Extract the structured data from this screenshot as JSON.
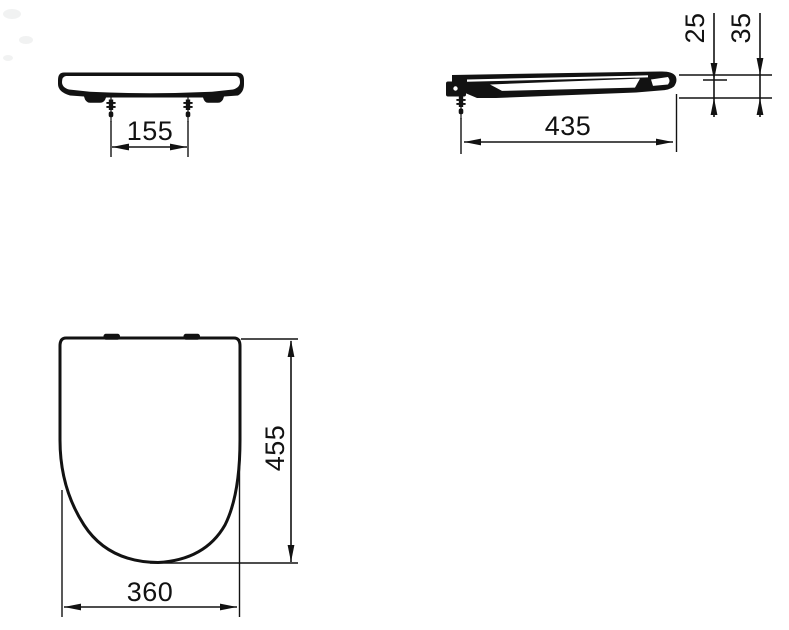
{
  "drawing": {
    "kind": "technical-dimension-drawing",
    "subject": "toilet-seat-with-cover",
    "units": "mm"
  },
  "colors": {
    "ink": "#121212",
    "paper": "#ffffff"
  },
  "views": {
    "front_view": {
      "dims": {
        "bolt_spacing_mm": "155"
      }
    },
    "side_view": {
      "dims": {
        "length_mm": "435",
        "seat_thickness_mm": "25",
        "overall_height_mm": "35"
      }
    },
    "plan_view": {
      "dims": {
        "depth_mm": "455",
        "width_mm": "360"
      }
    }
  }
}
